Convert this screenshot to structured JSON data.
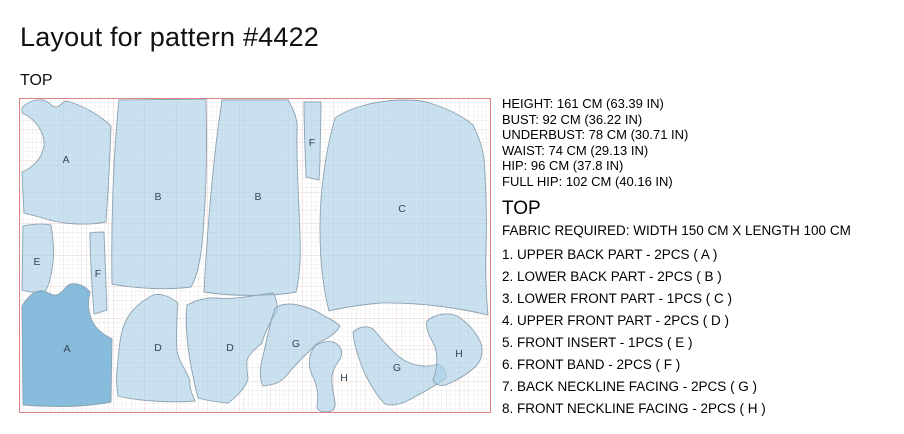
{
  "title": "Layout for pattern #4422",
  "layout_panel": {
    "section_label": "TOP",
    "piece_labels": [
      {
        "letter": "A",
        "x": 47,
        "y": 65
      },
      {
        "letter": "B",
        "x": 139,
        "y": 102
      },
      {
        "letter": "B",
        "x": 239,
        "y": 102
      },
      {
        "letter": "F",
        "x": 293,
        "y": 48
      },
      {
        "letter": "C",
        "x": 383,
        "y": 114
      },
      {
        "letter": "E",
        "x": 18,
        "y": 167
      },
      {
        "letter": "F",
        "x": 79,
        "y": 179
      },
      {
        "letter": "A",
        "x": 48,
        "y": 254
      },
      {
        "letter": "D",
        "x": 139,
        "y": 253
      },
      {
        "letter": "D",
        "x": 211,
        "y": 253
      },
      {
        "letter": "G",
        "x": 277,
        "y": 249
      },
      {
        "letter": "H",
        "x": 325,
        "y": 283
      },
      {
        "letter": "G",
        "x": 378,
        "y": 273
      },
      {
        "letter": "H",
        "x": 440,
        "y": 259
      }
    ],
    "colors": {
      "piece_fill": "#a9cfe7",
      "piece_fill_selected": "#7db6d9",
      "piece_outline": "#8da2b0",
      "fabric_border": "#dd8282",
      "grid_minor": "#e4e4e4",
      "grid_mid": "#d6d6d6",
      "grid_major": "#eec6c6"
    }
  },
  "info_panel": {
    "measurements": [
      "HEIGHT: 161 CM (63.39 IN)",
      "BUST: 92 CM (36.22 IN)",
      "UNDERBUST: 78 CM (30.71 IN)",
      "WAIST: 74 CM (29.13 IN)",
      "HIP: 96 CM (37.8 IN)",
      "FULL HIP: 102 CM (40.16 IN)"
    ],
    "section_heading": "TOP",
    "fabric_required": "FABRIC REQUIRED: WIDTH 150 CM X LENGTH 100 CM",
    "pieces": [
      "1. UPPER BACK PART - 2PCS ( A )",
      "2. LOWER BACK PART - 2PCS ( B )",
      "3. LOWER FRONT PART - 1PCS ( C )",
      "4. UPPER FRONT PART - 2PCS ( D )",
      "5. FRONT INSERT - 1PCS ( E )",
      "6. FRONT BAND - 2PCS ( F )",
      "7. BACK NECKLINE FACING - 2PCS ( G )",
      "8. FRONT NECKLINE FACING - 2PCS ( H )"
    ]
  }
}
